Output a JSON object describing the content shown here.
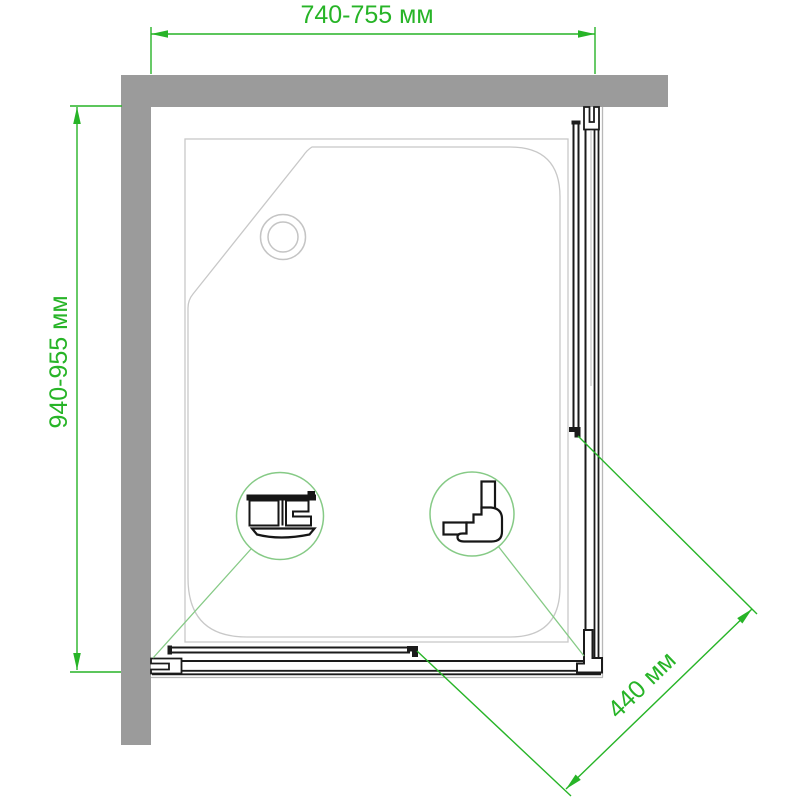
{
  "drawing": {
    "title": "shower-enclosure-plan-view",
    "dimension_labels": {
      "width": "740-755 мм",
      "depth": "940-955 мм",
      "door_opening": "440 мм"
    },
    "colors": {
      "dimension_green": "#27b427",
      "detail_green": "#86ca86",
      "wall_gray": "#9b9b9b",
      "profile_dark": "#1b1b1b",
      "frame_light": "#b8b8b8",
      "tray_light": "#c8c8c8",
      "background": "#ffffff"
    }
  }
}
